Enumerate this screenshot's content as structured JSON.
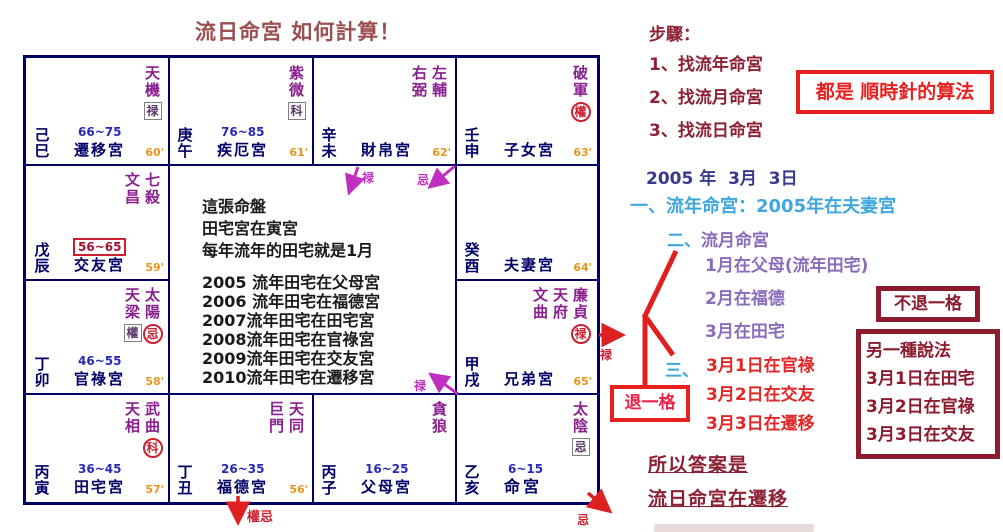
{
  "title": "流日命宮 如何計算！",
  "chart": {
    "cells": [
      {
        "pos": "si",
        "stem": "己巳",
        "stars": [
          {
            "name": "天機",
            "mark": {
              "text": "禄",
              "style": "box"
            }
          }
        ],
        "age": "66~75",
        "age_boxed": false,
        "palace": "遷移宮",
        "minute": "60'",
        "bold": false
      },
      {
        "pos": "wu",
        "stem": "庚午",
        "stars": [
          {
            "name": "紫微",
            "mark": {
              "text": "科",
              "style": "box"
            }
          }
        ],
        "age": "76~85",
        "age_boxed": false,
        "palace": "疾厄宮",
        "minute": "61'",
        "bold": false
      },
      {
        "pos": "wei",
        "stem": "辛未",
        "stars": [
          {
            "name": "右弼"
          },
          {
            "name": "左輔"
          }
        ],
        "age": "",
        "age_boxed": false,
        "palace": "財帛宮",
        "minute": "62'",
        "bold": false
      },
      {
        "pos": "shen",
        "stem": "壬申",
        "stars": [
          {
            "name": "破軍",
            "mark": {
              "text": "權",
              "style": "circle"
            }
          }
        ],
        "age": "",
        "age_boxed": false,
        "palace": "子女宮",
        "minute": "63'",
        "bold": false
      },
      {
        "pos": "chen",
        "stem": "戊辰",
        "stars": [
          {
            "name": "文昌"
          },
          {
            "name": "七殺"
          }
        ],
        "age": "56~65",
        "age_boxed": true,
        "palace": "交友宮",
        "minute": "59'",
        "bold": false
      },
      {
        "pos": "you",
        "stem": "癸酉",
        "stars": [],
        "age": "",
        "age_boxed": false,
        "palace": "夫妻宮",
        "minute": "64'",
        "bold": false
      },
      {
        "pos": "mao",
        "stem": "丁卯",
        "stars": [
          {
            "name": "天梁",
            "mark": {
              "text": "權",
              "style": "box"
            }
          },
          {
            "name": "太陽",
            "mark": {
              "text": "忌",
              "style": "circle"
            }
          }
        ],
        "age": "46~55",
        "age_boxed": false,
        "palace": "官祿宮",
        "minute": "58'",
        "bold": false
      },
      {
        "pos": "xu",
        "stem": "甲戌",
        "stars": [
          {
            "name": "文曲"
          },
          {
            "name": "天府"
          },
          {
            "name": "廉貞",
            "mark": {
              "text": "禄",
              "style": "circle"
            }
          }
        ],
        "age": "",
        "age_boxed": false,
        "palace": "兄弟宮",
        "minute": "65'",
        "bold": false
      },
      {
        "pos": "yin",
        "stem": "丙寅",
        "stars": [
          {
            "name": "天相"
          },
          {
            "name": "武曲",
            "mark": {
              "text": "科",
              "style": "circle"
            }
          }
        ],
        "age": "36~45",
        "age_boxed": false,
        "palace": "田宅宮",
        "minute": "57'",
        "bold": false
      },
      {
        "pos": "chou",
        "stem": "丁丑",
        "stars": [
          {
            "name": "巨門"
          },
          {
            "name": "天同"
          }
        ],
        "age": "26~35",
        "age_boxed": false,
        "palace": "福德宮",
        "minute": "56'",
        "bold": false
      },
      {
        "pos": "zi",
        "stem": "丙子",
        "stars": [
          {
            "name": "貪狼"
          }
        ],
        "age": "16~25",
        "age_boxed": false,
        "palace": "父母宮",
        "minute": "",
        "bold": false
      },
      {
        "pos": "hai",
        "stem": "乙亥",
        "stars": [
          {
            "name": "太陰",
            "mark": {
              "text": "忌",
              "style": "box"
            }
          }
        ],
        "age": "6~15",
        "age_boxed": false,
        "palace": "命宮",
        "minute": "",
        "bold": true
      }
    ],
    "center": {
      "lines": [
        "這張命盤",
        "田宅宮在寅宮",
        "每年流年的田宅就是1月",
        "",
        "2005 流年田宅在父母宮",
        "2006 流年田宅在福德宮",
        "2007流年田宅在田宅宮",
        "2008流年田宅在官祿宮",
        "2009流年田宅在交友宮",
        "2010流年田宅在遷移宮"
      ]
    }
  },
  "annotations": {
    "lu_top": "禄",
    "ji_top": "忌",
    "lu_bottom": "禄",
    "lu_right": "禄",
    "quan_ji": "權忌",
    "ji_corner": "忌"
  },
  "panel": {
    "steps_title": "步驟：",
    "steps": [
      "1、找流年命宮",
      "2、找流月命宮",
      "3、找流日命宮"
    ],
    "clockwise_note": "都是 順時針的算法",
    "date": "2005 年  3月  3日",
    "year_line": "一、流年命宮：2005年在夫妻宮",
    "month_num": "二、",
    "month_label": "流月命宮",
    "months": [
      "1月在父母(流年田宅)",
      "2月在福德",
      "3月在田宅"
    ],
    "day_num": "三、",
    "days": [
      "3月1日在官祿",
      "3月2日在交友",
      "3月3日在遷移"
    ],
    "step_back": "退一格",
    "no_step_back": "不退一格",
    "alt_box": [
      "另一種說法",
      "3月1日在田宅",
      "3月2日在官祿",
      "3月3日在交友"
    ],
    "answer1": "所以答案是",
    "answer2": "流日命宮在遷移"
  },
  "colors": {
    "grid": "#000066",
    "star_purple": "#8a1f8f",
    "transform_red": "#cc2030",
    "age_blue": "#2929b8",
    "minute_orange": "#e8951e",
    "title_brick": "#9c4f4f",
    "panel_maroon": "#8c2135",
    "bright_red": "#e82020",
    "cyan": "#3fa7dc",
    "month_purple": "#8a6cba",
    "date_navy": "#39398f"
  }
}
